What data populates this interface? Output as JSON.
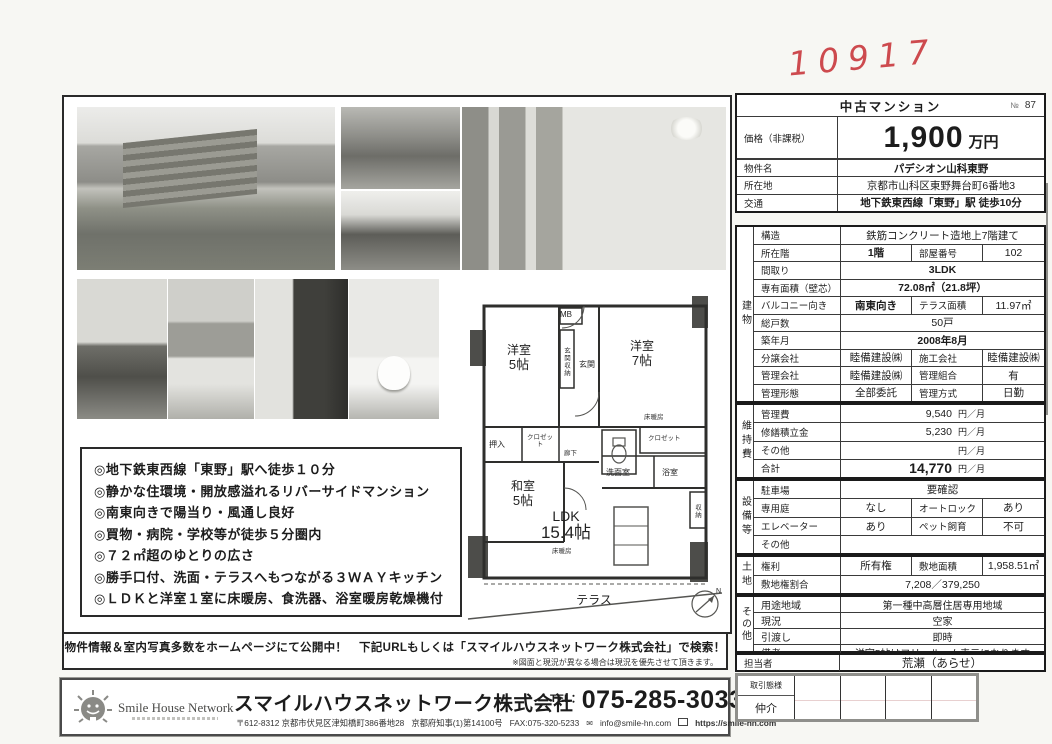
{
  "annotations": {
    "number": "10917",
    "note": "専任"
  },
  "listing": {
    "header_title": "中古マンション",
    "header_no_symbol": "№",
    "header_no_value": "87",
    "price_label": "価格（非課税）",
    "price_value": "1,900",
    "price_unit": "万円",
    "top_rows": [
      {
        "label": "物件名",
        "value": "パデシオン山科東野"
      },
      {
        "label": "所在地",
        "value": "京都市山科区東野舞台町6番地3"
      },
      {
        "label": "交通",
        "value": "地下鉄東西線「東野」駅 徒歩10分"
      }
    ]
  },
  "sections": {
    "building": {
      "label": "建物",
      "rows": [
        {
          "label": "構造",
          "value": "鉄筋コンクリート造地上7階建て"
        },
        {
          "label": "所在階",
          "value": "1階",
          "label2": "部屋番号",
          "value2": "102"
        },
        {
          "label": "間取り",
          "value": "3LDK"
        },
        {
          "label": "専有面積（壁芯）",
          "value": "72.08㎡（21.8坪）"
        },
        {
          "label": "バルコニー向き",
          "value": "南東向き",
          "label2": "テラス面積",
          "value2": "11.97㎡"
        },
        {
          "label": "総戸数",
          "value": "50戸"
        },
        {
          "label": "築年月",
          "value": "2008年8月"
        },
        {
          "label": "分譲会社",
          "value": "睦備建設㈱",
          "label2": "施工会社",
          "value2": "睦備建設㈱"
        },
        {
          "label": "管理会社",
          "value": "睦備建設㈱",
          "label2": "管理組合",
          "value2": "有"
        },
        {
          "label": "管理形態",
          "value": "全部委託",
          "label2": "管理方式",
          "value2": "日勤"
        }
      ]
    },
    "maintenance": {
      "label": "維持費",
      "rows": [
        {
          "label": "管理費",
          "value": "9,540",
          "unit": "円／月"
        },
        {
          "label": "修繕積立金",
          "value": "5,230",
          "unit": "円／月"
        },
        {
          "label": "その他",
          "value": "",
          "unit": "円／月"
        },
        {
          "label": "合計",
          "value": "14,770",
          "unit": "円／月"
        }
      ]
    },
    "facilities": {
      "label": "設備等",
      "rows": [
        {
          "label": "駐車場",
          "value": "要確認"
        },
        {
          "label": "専用庭",
          "value": "なし",
          "label2": "オートロック",
          "value2": "あり"
        },
        {
          "label": "エレベーター",
          "value": "あり",
          "label2": "ペット飼育",
          "value2": "不可"
        },
        {
          "label": "その他",
          "value": ""
        }
      ]
    },
    "land": {
      "label": "土地",
      "rows": [
        {
          "label": "権利",
          "value": "所有権",
          "label2": "敷地面積",
          "value2": "1,958.51㎡"
        },
        {
          "label": "敷地権割合",
          "value": "7,208／379,250"
        }
      ]
    },
    "other": {
      "label": "その他",
      "rows": [
        {
          "label": "用途地域",
          "value": "第一種中高層住居専用地域"
        },
        {
          "label": "現況",
          "value": "空家"
        },
        {
          "label": "引渡し",
          "value": "即時"
        },
        {
          "label": "備考",
          "value": "洋室5帖はフリールーム表示になります"
        }
      ]
    },
    "staff": {
      "label": "担当者",
      "value": "荒瀬（あらせ）"
    }
  },
  "features": {
    "items": [
      "◎地下鉄東西線「東野」駅へ徒歩１０分",
      "◎静かな住環境・開放感溢れるリバーサイドマンション",
      "◎南東向きで陽当り・風通し良好",
      "◎買物・病院・学校等が徒歩５分圏内",
      "◎７２㎡超のゆとりの広さ",
      "◎勝手口付、洗面・テラスへもつながる３ＷＡＹキッチン",
      "◎ＬＤＫと洋室１室に床暖房、食洗器、浴室暖房乾燥機付"
    ]
  },
  "floorplan": {
    "mb": "MB",
    "entrance_storage": "玄関収納",
    "entrance": "玄関",
    "west_room_small_name": "洋室",
    "west_room_small_size": "5帖",
    "west_room_large_name": "洋室",
    "west_room_large_size": "7帖",
    "floor_heating": "床暖房",
    "oshiire": "押入",
    "closet": "クロゼット",
    "corridor": "廊下",
    "japanese_room_name": "和室",
    "japanese_room_size": "5帖",
    "washroom": "洗面室",
    "bathroom": "浴室",
    "storage": "収納",
    "ldk_name": "LDK",
    "ldk_size": "15.4帖",
    "terrace": "テラス",
    "compass_n": "N"
  },
  "notice": {
    "line1": "物件情報＆室内写真多数をホームページにて公開中！　下記URLもしくは「スマイルハウスネットワーク株式会社」で検索！",
    "line2": "※図面と現況が異なる場合は現況を優先させて頂きます。"
  },
  "company": {
    "logo_text": "Smile House Network",
    "name": "スマイルハウスネットワーク株式会社",
    "tel_label": "TEL：",
    "tel": "075-285-3033",
    "postal_address": "〒612-8312 京都市伏見区津知橋町386番地28",
    "license": "京都府知事(1)第14100号",
    "fax": "FAX:075-320-5233",
    "email": "info@smile-hn.com",
    "url": "https://smile-hn.com"
  },
  "dealbox": {
    "label": "取引態様",
    "value": "仲介"
  }
}
